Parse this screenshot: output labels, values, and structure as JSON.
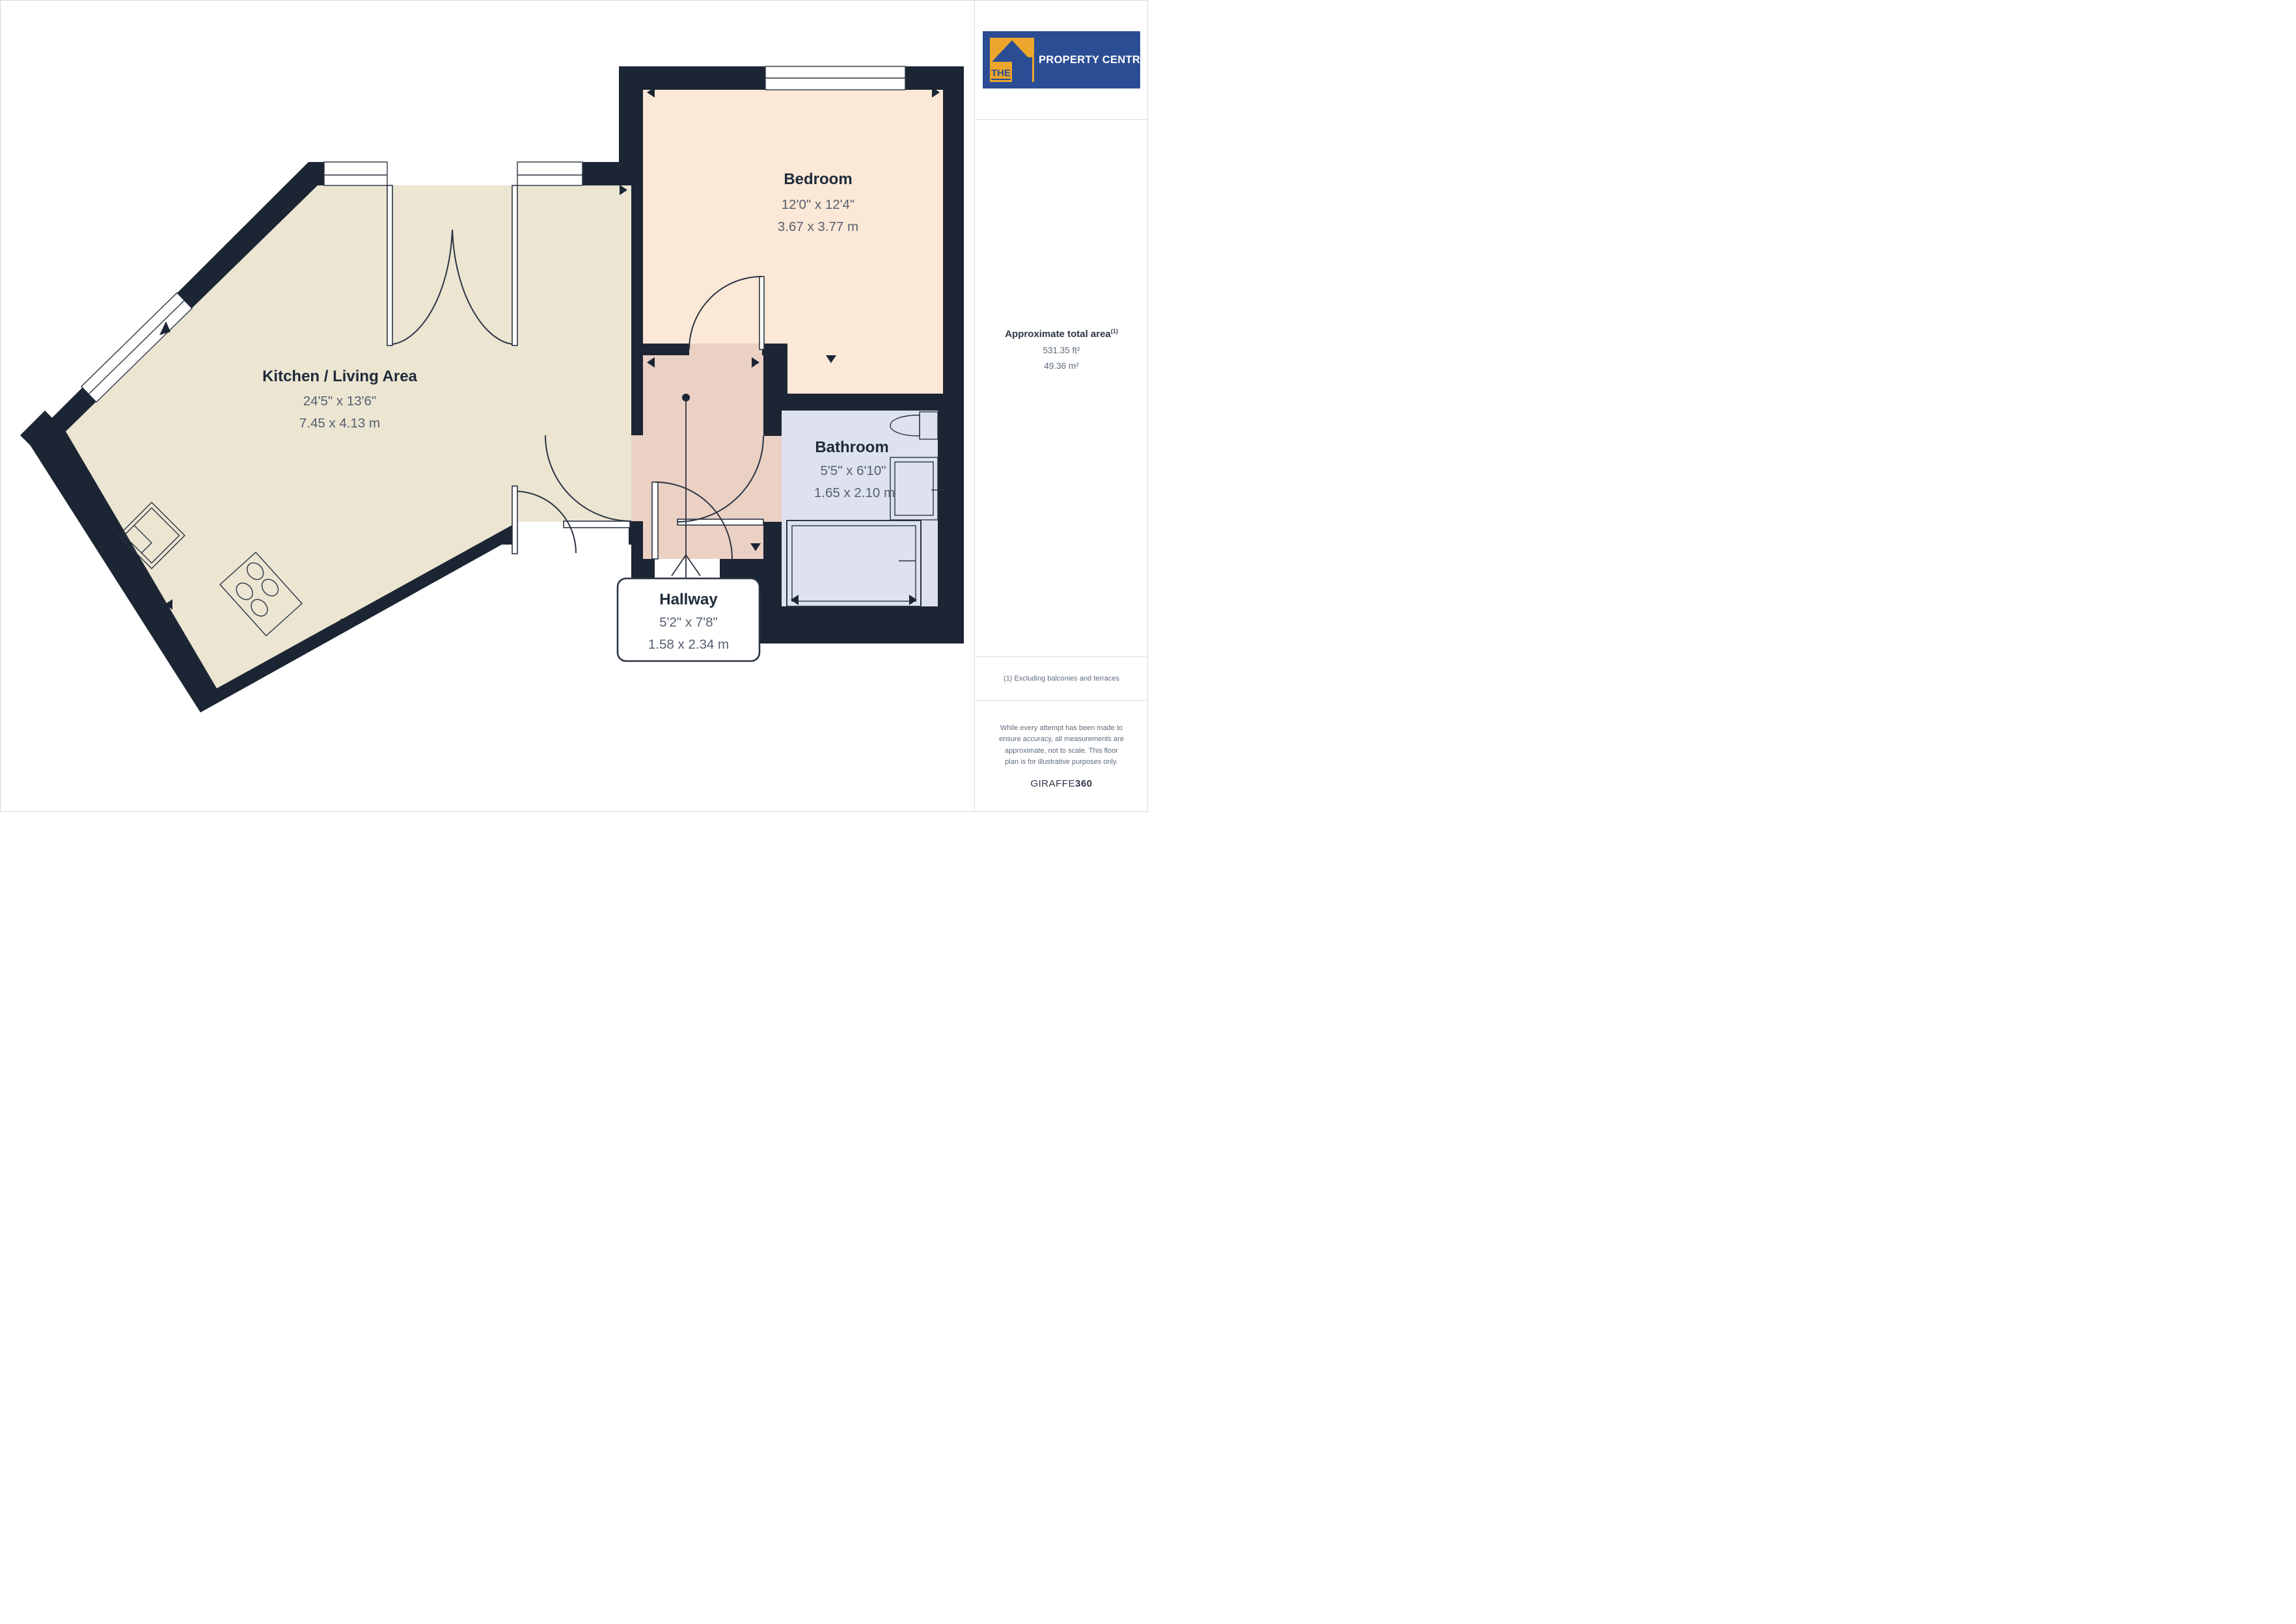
{
  "branding": {
    "logo_the": "THE",
    "logo_rest": "PROPERTY CENTRE",
    "logo_bg": "#2b4d93",
    "logo_accent": "#eda62c",
    "giraffe_prefix": "GIRAFFE",
    "giraffe_suffix": "360"
  },
  "sidebar": {
    "area_title": "Approximate total area",
    "area_superscript": "(1)",
    "area_ft": "531.35 ft²",
    "area_m": "49.36 m²",
    "note": "(1) Excluding balconies and terraces",
    "disclaimer_lines": [
      "While every attempt has been made to",
      "ensure accuracy, all measurements are",
      "approximate, not to scale. This floor",
      "plan is for illustrative purposes only."
    ]
  },
  "floor_plan": {
    "colors": {
      "wall": "#1c2533",
      "kitchen_floor": "#ebe5d2",
      "bedroom_floor": "#fce8d6",
      "hallway_floor": "#ebd0c4",
      "bathroom_floor": "#dde2ee",
      "label_text": "#202b3a",
      "dims_text": "#566070"
    },
    "rooms": [
      {
        "id": "kitchen",
        "name": "Kitchen / Living Area",
        "imperial": "24'5\" x 13'6\"",
        "metric": "7.45 x 4.13 m"
      },
      {
        "id": "bedroom",
        "name": "Bedroom",
        "imperial": "12'0\" x 12'4\"",
        "metric": "3.67 x 3.77 m"
      },
      {
        "id": "bathroom",
        "name": "Bathroom",
        "imperial": "5'5\" x 6'10\"",
        "metric": "1.65 x 2.10 m"
      },
      {
        "id": "hallway",
        "name": "Hallway",
        "imperial": "5'2\" x 7'8\"",
        "metric": "1.58 x 2.34 m"
      }
    ]
  }
}
